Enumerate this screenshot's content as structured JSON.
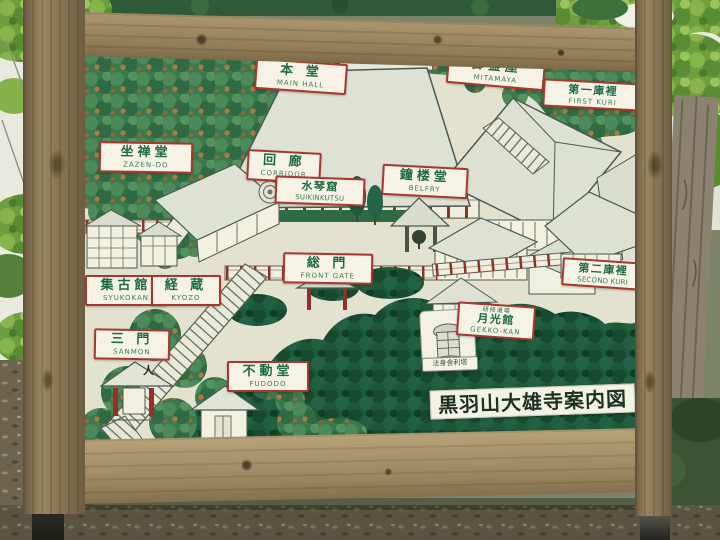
{
  "sign_title": {
    "text": "黒羽山大雄寺案内図"
  },
  "labels": [
    {
      "id": "main-hall",
      "kanji": "本 堂",
      "romaji": "MAIN HALL"
    },
    {
      "id": "mitamaya",
      "kanji": "御霊屋",
      "romaji": "MITAMAYA"
    },
    {
      "id": "first-kuri",
      "kanji": "第一庫裡",
      "romaji": "FIRST KURI"
    },
    {
      "id": "zazen-do",
      "kanji": "坐禅堂",
      "romaji": "ZAZEN-DO"
    },
    {
      "id": "corridor",
      "kanji": "回 廊",
      "romaji": "CORRIDOR"
    },
    {
      "id": "suikinkutsu",
      "kanji": "水琴窟",
      "romaji": "SUIKINKUTSU"
    },
    {
      "id": "belfry",
      "kanji": "鐘楼堂",
      "romaji": "BELFRY"
    },
    {
      "id": "front-gate",
      "kanji": "総 門",
      "romaji": "FRONT GATE"
    },
    {
      "id": "syukokan",
      "kanji": "集古館",
      "romaji": "SYUKOKAN"
    },
    {
      "id": "kyozo",
      "kanji": "経 蔵",
      "romaji": "KYOZO"
    },
    {
      "id": "sanmon",
      "kanji": "三 門",
      "romaji": "SANMON"
    },
    {
      "id": "fudodo",
      "kanji": "不動堂",
      "romaji": "FUDODO"
    },
    {
      "id": "gekko-kan",
      "annotation": "研修道場",
      "kanji": "月光館",
      "romaji": "GEKKO-KAN"
    },
    {
      "id": "second-kuri",
      "kanji": "第二庫裡",
      "romaji": "SECOND KURI"
    },
    {
      "id": "sharito",
      "kanji": "法身舎利塔",
      "romaji": ""
    }
  ],
  "marks": {
    "person": "人"
  },
  "colors": {
    "label_border": "#a8372e",
    "label_text_green": "#1e6b42",
    "forest_green": "#3c7a4e",
    "forest_dark": "#1d5839",
    "board_cream": "#e3e2d0",
    "wood_brown": "#97825c",
    "pillar_red": "#8e3129"
  }
}
